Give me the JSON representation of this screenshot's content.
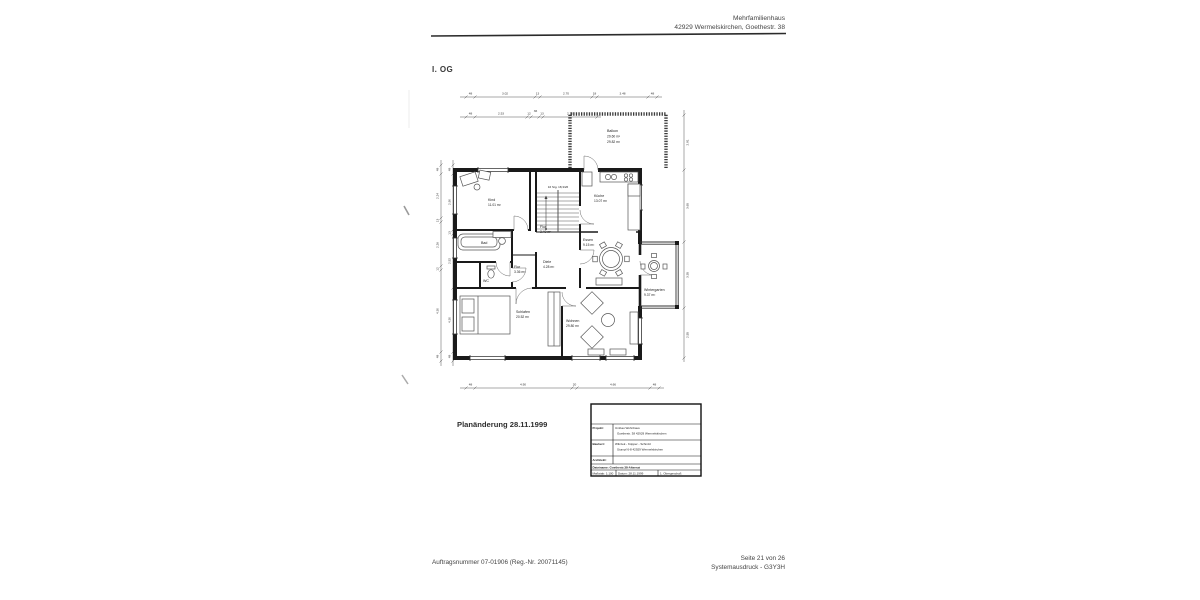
{
  "document": {
    "header": {
      "line1": "Mehrfamilienhaus",
      "line2": "42929 Wermelskirchen, Goethestr. 38"
    },
    "floor_label": "I. OG",
    "plan_change_note": "Planänderung 28.11.1999",
    "footer": {
      "order_number": "Auftragsnummer 07-01906 (Reg.-Nr. 20071145)",
      "page": "Seite 21 von 26",
      "printout": "Systemausdruck - G3Y3H"
    }
  },
  "plan": {
    "rooms": {
      "balkon": {
        "name": "Balkon",
        "area1": "29.60 m²",
        "area2": "29.82 m²"
      },
      "kind": {
        "name": "Kind",
        "area": "11.01 m²"
      },
      "bad": {
        "name": "Bad"
      },
      "wc": {
        "name": "WC"
      },
      "flur_oben": {
        "name": "Flur",
        "area": "3.40 m²"
      },
      "flur": {
        "name": "Flur",
        "area": "3.36 m²"
      },
      "diele": {
        "name": "Diele",
        "area": "4.28 m²"
      },
      "kueche": {
        "name": "Küche",
        "area": "13.07 m²"
      },
      "essen": {
        "name": "Essen",
        "area": "9.15 m²"
      },
      "schlafen": {
        "name": "Schlafen",
        "area": "20.52 m²"
      },
      "wohnen": {
        "name": "Wohnen",
        "area": "29.80 m²"
      },
      "wintergarten": {
        "name": "Wintergarten",
        "area": "9.37 m²"
      }
    },
    "stairs_label": "16 Stg. 18,3/26",
    "dims": {
      "top1": [
        "48",
        "3.02",
        "13",
        "2.70",
        "18",
        "3.48",
        "48"
      ],
      "top2": [
        "48",
        "2.53",
        "12",
        "36",
        "13",
        "2.70"
      ],
      "bottom": [
        "48",
        "4.90",
        "20",
        "4.66",
        "48"
      ],
      "left_outer": [
        "48",
        "2.24",
        "13",
        "2.26",
        "12",
        "4.30",
        "48"
      ],
      "left_inner": [
        "48",
        "2.90",
        "13",
        "2.52",
        "4.30",
        "48"
      ],
      "right": [
        "2.81",
        "3.65",
        "3.35",
        "2.55"
      ]
    }
  },
  "title_block": {
    "projekt_label": "Projekt:",
    "projekt_1": "Umbau Wohnhaus",
    "projekt_2": "Goethestr. 38 42929 Wermelskirchen",
    "bauherr_label": "Bauherr:",
    "bauherr_1": "Wilczek - Küpper - Schmitz",
    "bauherr_2": "Stumpf 6-8 42929 Wermelskirchen",
    "architekt_label": "Architekt:",
    "datei": "Dateiname: Goethestr.38-Alternat",
    "massstab": "Maßstab:  1:100",
    "datum": "Datum:  28.11.1999",
    "geschoss": "1. Obergeschoß"
  }
}
